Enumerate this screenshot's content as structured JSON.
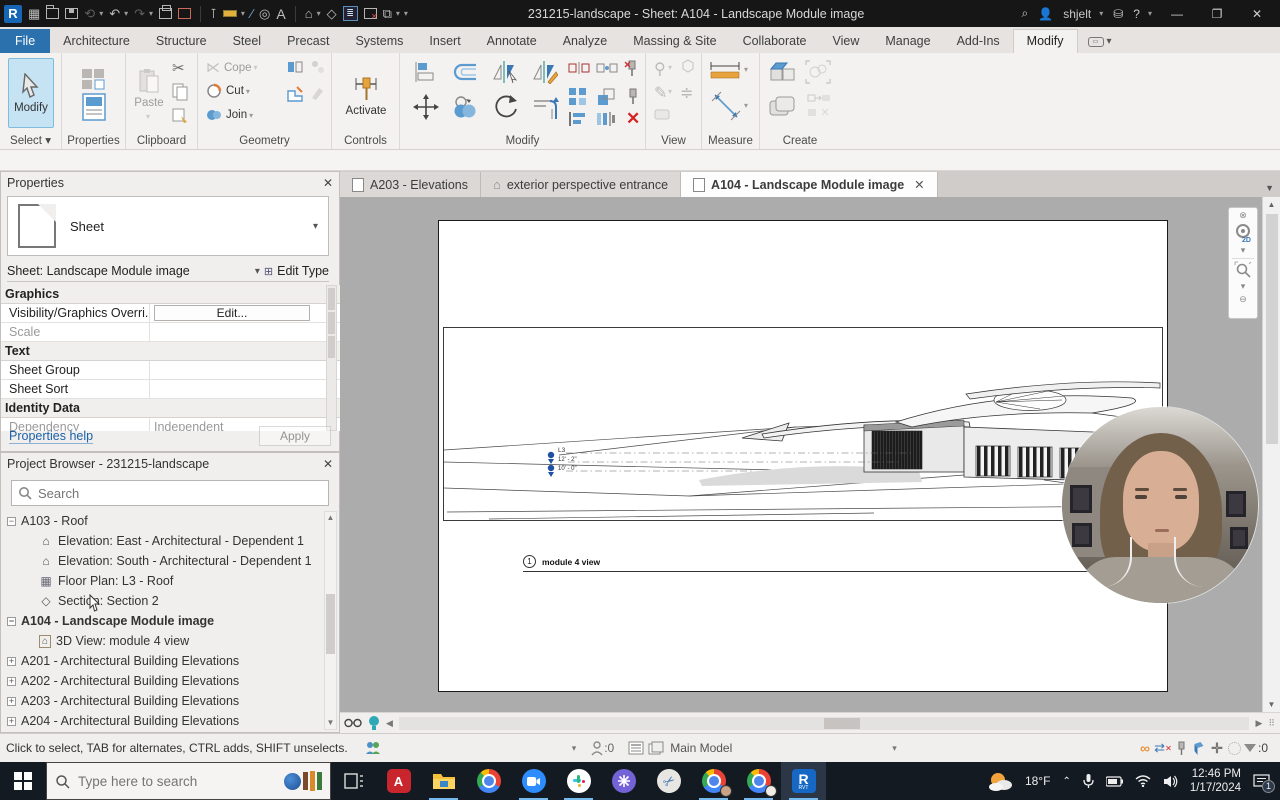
{
  "title_bar": {
    "title": "231215-landscape - Sheet: A104 - Landscape Module image",
    "user": "shjelt",
    "qat_icons": [
      "revit-logo",
      "ui-board",
      "open",
      "save",
      "sync",
      "undo",
      "redo",
      "print",
      "close-doc",
      "modify-pin",
      "dimension",
      "section",
      "tag",
      "text",
      "default-3d-view",
      "thin-lines",
      "close-inactive",
      "switch-windows"
    ]
  },
  "ribbon": {
    "tabs": [
      "File",
      "Architecture",
      "Structure",
      "Steel",
      "Precast",
      "Systems",
      "Insert",
      "Annotate",
      "Analyze",
      "Massing & Site",
      "Collaborate",
      "View",
      "Manage",
      "Add-Ins",
      "Modify"
    ],
    "active_tab": "Modify",
    "buttons": {
      "modify": "Modify",
      "properties": "Properties",
      "paste": "Paste",
      "cope": "Cope",
      "cut": "Cut",
      "join": "Join",
      "activate": "Activate"
    },
    "panel_labels": {
      "select": "Select",
      "properties": "Properties",
      "clipboard": "Clipboard",
      "geometry": "Geometry",
      "controls": "Controls",
      "modify": "Modify",
      "view": "View",
      "measure": "Measure",
      "create": "Create"
    }
  },
  "doc_tabs": [
    {
      "label": "A203 - Elevations",
      "icon": "sheet"
    },
    {
      "label": "exterior perspective entrance",
      "icon": "3d-home"
    },
    {
      "label": "A104 - Landscape Module image",
      "icon": "sheet",
      "active": true
    }
  ],
  "properties_panel": {
    "title": "Properties",
    "type_name": "Sheet",
    "instance_selector": "Sheet: Landscape Module image",
    "edit_type": "Edit Type",
    "rows": [
      {
        "kind": "group",
        "label": "Graphics"
      },
      {
        "kind": "row",
        "label": "Visibility/Graphics Overri...",
        "value": "Edit..."
      },
      {
        "kind": "row",
        "label": "Scale",
        "value": ""
      },
      {
        "kind": "group",
        "label": "Text"
      },
      {
        "kind": "row",
        "label": "Sheet Group",
        "value": ""
      },
      {
        "kind": "row",
        "label": "Sheet Sort",
        "value": ""
      },
      {
        "kind": "group",
        "label": "Identity Data"
      },
      {
        "kind": "row",
        "label": "Dependency",
        "value": "Independent"
      }
    ],
    "help_link": "Properties help",
    "apply_label": "Apply"
  },
  "project_browser": {
    "title": "Project Browser - 231215-landscape",
    "search_placeholder": "Search",
    "tree": [
      {
        "expander": "minus",
        "icon": "",
        "label": "A103 - Roof"
      },
      {
        "expander": "",
        "icon": "elevation",
        "label": "Elevation: East - Architectural - Dependent 1"
      },
      {
        "expander": "",
        "icon": "elevation",
        "label": "Elevation: South - Architectural - Dependent 1"
      },
      {
        "expander": "",
        "icon": "floor-plan",
        "label": "Floor Plan: L3 - Roof"
      },
      {
        "expander": "",
        "icon": "section",
        "label": "Section: Section 2"
      },
      {
        "expander": "minus",
        "icon": "",
        "label": "A104 - Landscape Module image",
        "bold": true
      },
      {
        "expander": "",
        "icon": "3d-view",
        "label": "3D View: module 4 view"
      },
      {
        "expander": "plus",
        "icon": "",
        "label": "A201 - Architectural Building Elevations"
      },
      {
        "expander": "plus",
        "icon": "",
        "label": "A202 - Architectural Building Elevations"
      },
      {
        "expander": "plus",
        "icon": "",
        "label": "A203 - Architectural Building Elevations"
      },
      {
        "expander": "plus",
        "icon": "",
        "label": "A204 - Architectural Building Elevations"
      }
    ]
  },
  "canvas": {
    "view_number": "1",
    "view_title": "module 4 view",
    "levels": [
      "L3",
      "12' - 2\"",
      "10' - 0\""
    ]
  },
  "status_bar": {
    "hint": "Click to select, TAB for alternates, CTRL adds, SHIFT unselects.",
    "editable_count": ":0",
    "main_model": "Main Model",
    "filter_count": ":0"
  },
  "taskbar": {
    "search_placeholder": "Type here to search",
    "temperature": "18°F",
    "time": "12:46 PM",
    "date": "1/17/2024",
    "notification_badge": "1",
    "apps": [
      "task-view",
      "acrobat",
      "file-explorer",
      "chrome",
      "zoom",
      "slack",
      "purple-app",
      "snip",
      "chrome-profile-1",
      "chrome-profile-2",
      "revit"
    ]
  }
}
